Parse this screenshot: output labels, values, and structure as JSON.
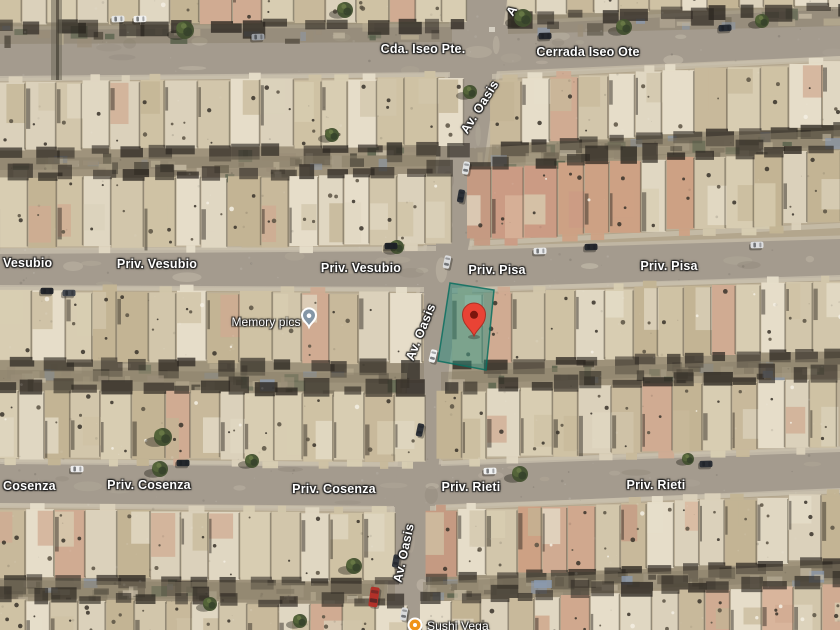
{
  "map": {
    "street_labels": [
      {
        "text": "Cda. Iseo Pte."
      },
      {
        "text": "Cerrada Iseo Ote"
      },
      {
        "text": "A"
      },
      {
        "text": "Av. Oasis"
      },
      {
        "text": "Vesubio"
      },
      {
        "text": "Priv. Vesubio"
      },
      {
        "text": "Priv. Vesubio"
      },
      {
        "text": "Priv. Pisa"
      },
      {
        "text": "Priv. Pisa"
      },
      {
        "text": "Av. Oasis"
      },
      {
        "text": "Cosenza"
      },
      {
        "text": "Priv. Cosenza"
      },
      {
        "text": "Priv. Cosenza"
      },
      {
        "text": "Priv. Rieti"
      },
      {
        "text": "Priv. Rieti"
      },
      {
        "text": "Av. Oasis"
      }
    ],
    "marker": {
      "color": "#e94335",
      "stroke": "#a93125",
      "dot_color": "#7c150d",
      "transform": "translate(474,336)"
    },
    "highlight": {
      "points": "450,283 494,290 486,370 438,361",
      "fill": "#1e8a7c",
      "fill_opacity": "0.45",
      "stroke": "#0b6e5f",
      "stroke_opacity": "0.85"
    },
    "pois": [
      {
        "label": "Memory pics",
        "pin_color": "#8496a6",
        "pin_transform": "translate(309,327)"
      },
      {
        "label": "Sushi Vega",
        "pin_color": "#f09317",
        "pin_transform": "translate(415,625)"
      }
    ]
  }
}
